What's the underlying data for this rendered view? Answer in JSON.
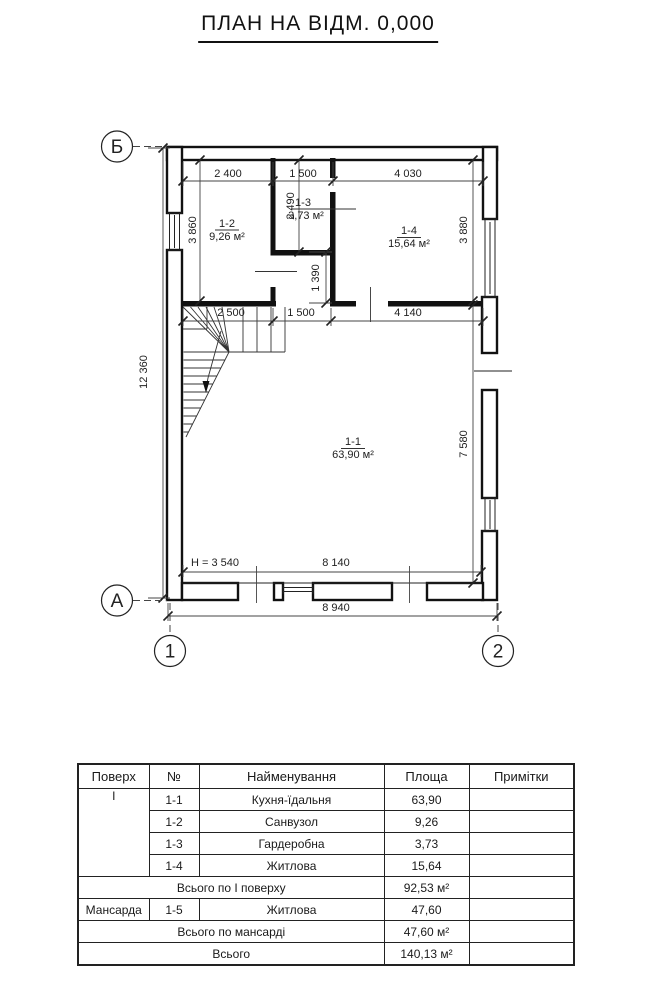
{
  "title": "ПЛАН НА ВІДМ. 0,000",
  "axes": {
    "b": "Б",
    "a": "А",
    "n1": "1",
    "n2": "2"
  },
  "rooms": {
    "r11": {
      "num": "1-1",
      "area": "63,90 м²"
    },
    "r12": {
      "num": "1-2",
      "area": "9,26 м²"
    },
    "r13": {
      "num": "1-3",
      "area": "3,73 м²"
    },
    "r14": {
      "num": "1-4",
      "area": "15,64 м²"
    }
  },
  "dims": {
    "top1": "2 400",
    "top2": "1 500",
    "top3": "4 030",
    "v_left": "3 860",
    "v_mid": "2 490",
    "v_right": "3 880",
    "v_hall": "1 390",
    "mid1": "2 500",
    "mid2": "1 500",
    "mid3": "4 140",
    "v_total": "12 360",
    "v_room": "7 580",
    "bottom_inner": "8 140",
    "bottom_outer": "8 940",
    "height_note": "H = 3 540"
  },
  "table": {
    "headers": [
      "Поверх",
      "№",
      "Найменування",
      "Площа",
      "Примітки"
    ],
    "rows": [
      {
        "floor": "І",
        "num": "1-1",
        "name": "Кухня-їдальня",
        "area": "63,90"
      },
      {
        "num": "1-2",
        "name": "Санвузол",
        "area": "9,26"
      },
      {
        "num": "1-3",
        "name": "Гардеробна",
        "area": "3,73"
      },
      {
        "num": "1-4",
        "name": "Житлова",
        "area": "15,64"
      },
      {
        "total_label": "Всього по І поверху",
        "area": "92,53 м²"
      },
      {
        "floor": "Мансарда",
        "num": "1-5",
        "name": "Житлова",
        "area": "47,60"
      },
      {
        "total_label": "Всього по мансарді",
        "area": "47,60 м²"
      },
      {
        "total_label": "Всього",
        "area": "140,13 м²"
      }
    ]
  }
}
